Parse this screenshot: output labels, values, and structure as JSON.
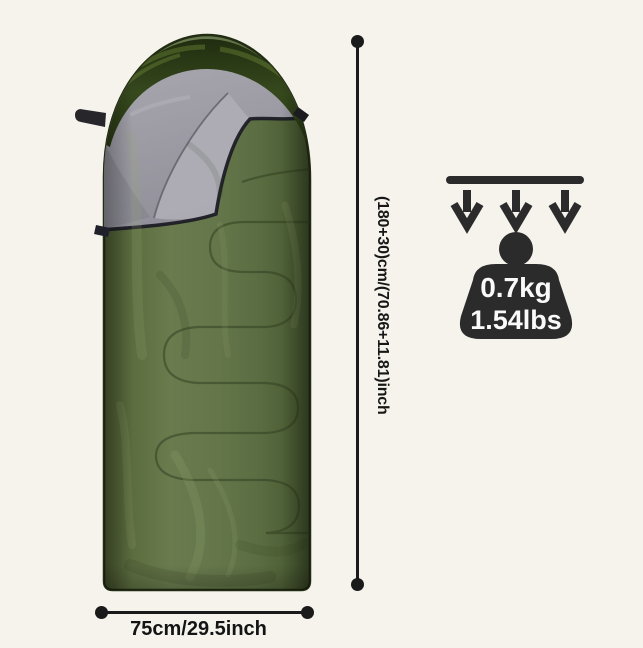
{
  "image": {
    "background_color": "#f5f3ec",
    "subject": "olive green envelope sleeping bag with rounded hood, top corner folded open showing gray lining, hanging loop and zipper"
  },
  "dimensions": {
    "height_label": "(180+30)cm/(70.86+11.81)inch",
    "width_label": "75cm/29.5inch",
    "line_color": "#1a1a1a"
  },
  "weight_badge": {
    "kg_label": "0.7kg",
    "lbs_label": "1.54lbs",
    "icon_color": "#2b2b2b",
    "text_color": "#fafafa"
  },
  "product_colors": {
    "shell_green": "#62744a",
    "hood_dark_green": "#2f3f1c",
    "lining_gray": "#9c9ba3",
    "trim_black": "#1e1e26"
  }
}
